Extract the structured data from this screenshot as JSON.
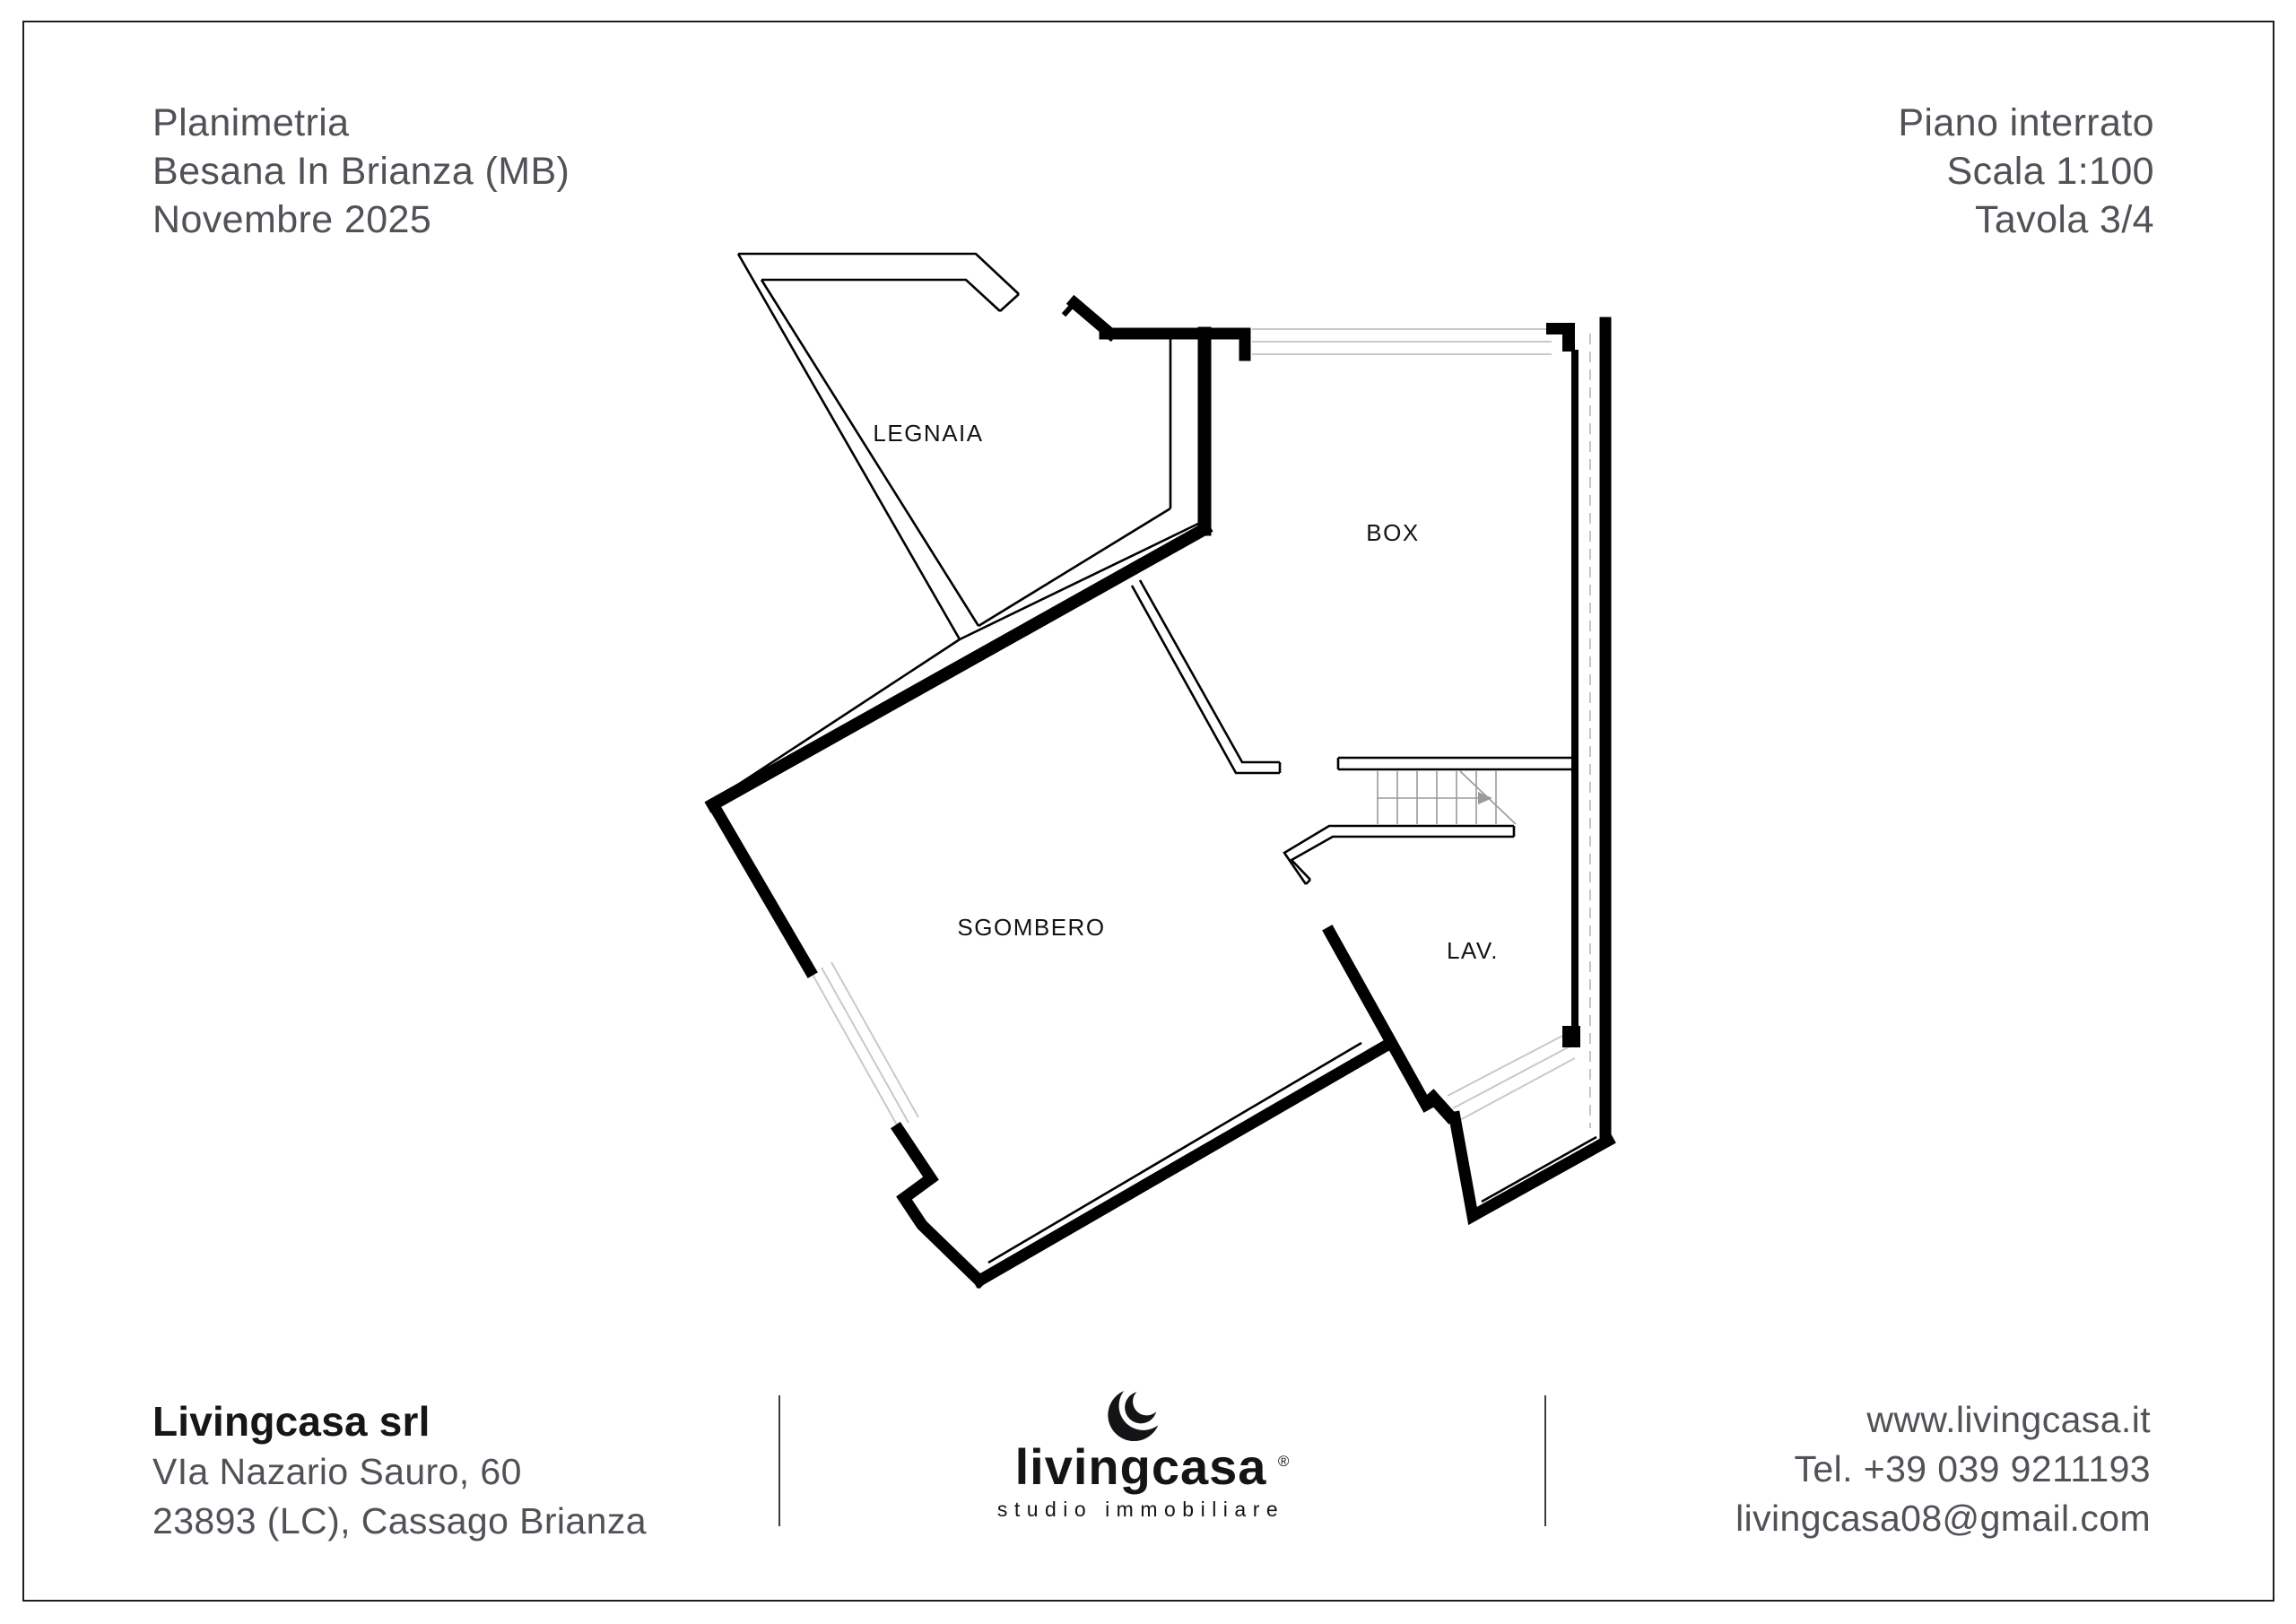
{
  "header": {
    "left_lines": [
      "Planimetria",
      "Besana In Brianza (MB)",
      "Novembre 2025"
    ],
    "right_lines": [
      "Piano interrato",
      "Scala 1:100",
      "Tavola 3/4"
    ]
  },
  "plan": {
    "rooms": [
      {
        "label": "LEGNAIA"
      },
      {
        "label": "BOX"
      },
      {
        "label": "SGOMBERO"
      },
      {
        "label": "LAV."
      }
    ],
    "features": [
      "stairs-up-arrow",
      "garage-door-opening",
      "window-openings",
      "dashed-boundary-line"
    ]
  },
  "footer": {
    "company_name": "Livingcasa srl",
    "address_line1": "VIa Nazario Sauro, 60",
    "address_line2": "23893 (LC), Cassago Brianza",
    "logo": {
      "wordmark": "livingcasa",
      "registered_mark": "®",
      "tagline": "studio immobiliare",
      "icon": "crescent-moon-icon"
    },
    "website": "www.livingcasa.it",
    "phone": "Tel. +39 039 9211193",
    "email": "livingcasa08@gmail.com"
  },
  "colors": {
    "ink": "#1b1b1d",
    "text_gray": "#515157",
    "plan_line": "#000000",
    "light_line": "#c9c9c9",
    "background": "#ffffff"
  }
}
